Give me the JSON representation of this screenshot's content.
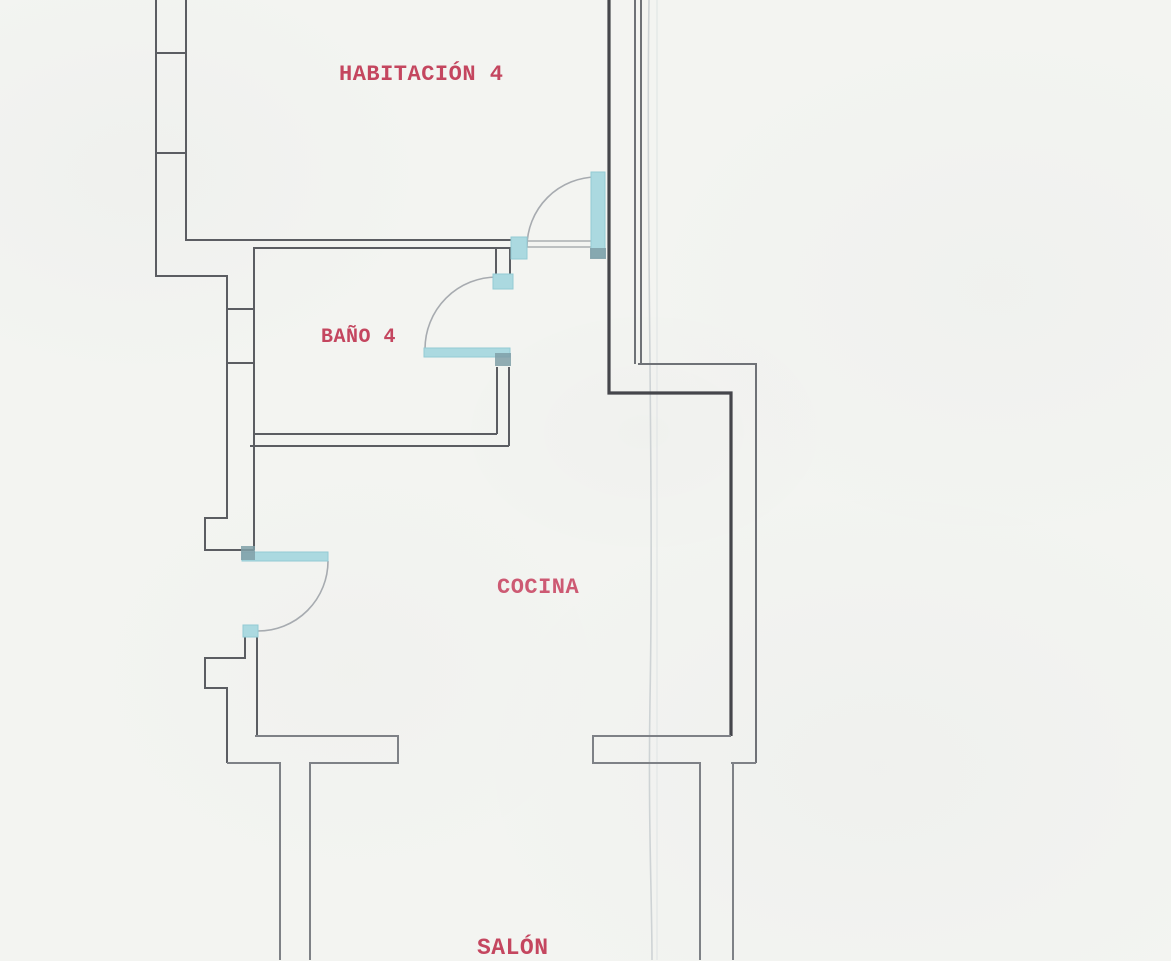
{
  "rooms": {
    "habitacion4": {
      "label": "HABITACIÓN 4"
    },
    "bano4": {
      "label": "BAÑO 4"
    },
    "cocina": {
      "label": "COCINA"
    },
    "salon": {
      "label": "SALÓN"
    }
  },
  "colors": {
    "paper": "#f3f4f1",
    "wall": "#5b5d62",
    "wall_mid": "#6f7277",
    "wall_light": "#7e8186",
    "wall_thick": "#45464b",
    "wall_thin": "#9ca0a5",
    "arc": "#a7abb0",
    "door": "#abd9e0",
    "door_edge": "#93cad4",
    "door_dark": "#7f9fa7",
    "fold": "#ced3d5",
    "fold2": "#e0e4e5",
    "label": "#c4465f",
    "label_cocina": "#cd5a73"
  }
}
